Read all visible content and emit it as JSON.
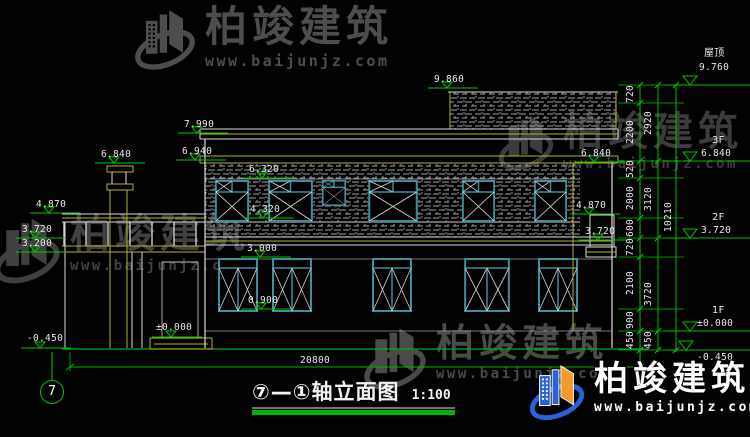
{
  "watermark": {
    "brand": "柏竣建筑",
    "url": "www.baijunjz.com"
  },
  "title": {
    "text": "⑦—①轴立面图",
    "scale": "1:100"
  },
  "axis_bubble": "7",
  "bottom_dim": "20800",
  "markers": [
    {
      "v": "9.860"
    },
    {
      "v": "7.990"
    },
    {
      "v": "6.940"
    },
    {
      "v": "6.840"
    },
    {
      "v": "6.320"
    },
    {
      "v": "4.320"
    },
    {
      "v": "4.870"
    },
    {
      "v": "3.720"
    },
    {
      "v": "3.200"
    },
    {
      "v": "3.000"
    },
    {
      "v": "0.900"
    },
    {
      "v": "±0.000"
    },
    {
      "v": "-0.450"
    },
    {
      "v": "6.840"
    },
    {
      "v": "4.870"
    },
    {
      "v": "3.720"
    }
  ],
  "levels": [
    {
      "label": "屋顶",
      "value": "9.760"
    },
    {
      "label": "3F",
      "value": "6.840"
    },
    {
      "label": "2F",
      "value": "3.720"
    },
    {
      "label": "1F",
      "value": "±0.000"
    },
    {
      "label": "",
      "value": "-0.450"
    }
  ],
  "vdims": {
    "chain1": [
      "720",
      "2200",
      "520",
      "2000",
      "600",
      "720",
      "2100",
      "900",
      "450"
    ],
    "chain2": [
      "2920",
      "3120",
      "3720",
      "450"
    ],
    "total": "10210"
  }
}
